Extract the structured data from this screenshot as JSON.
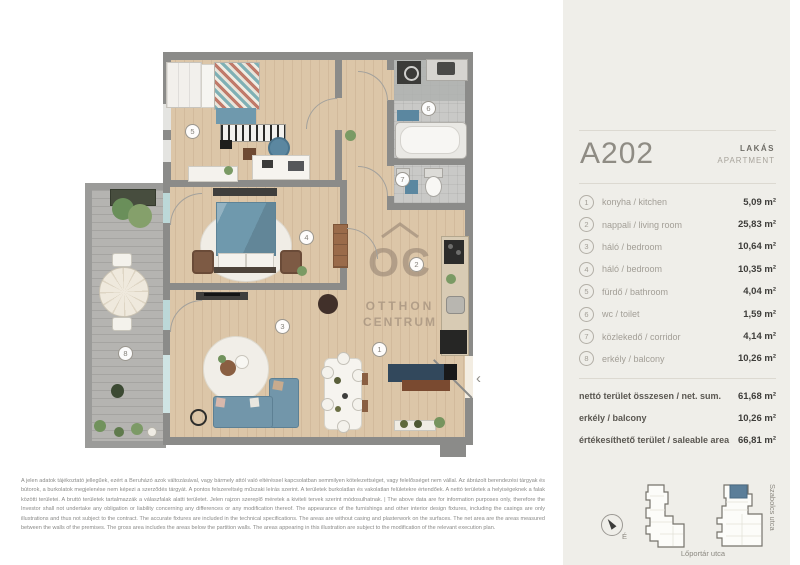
{
  "panel": {
    "unit_id": "A202",
    "type_hu": "LAKÁS",
    "type_en": "APARTMENT",
    "rooms": [
      {
        "num": "1",
        "label": "konyha  /  kitchen",
        "area": "5,09 m²"
      },
      {
        "num": "2",
        "label": "nappali  /  living room",
        "area": "25,83 m²"
      },
      {
        "num": "3",
        "label": "háló  /  bedroom",
        "area": "10,64 m²"
      },
      {
        "num": "4",
        "label": "háló  /  bedroom",
        "area": "10,35 m²"
      },
      {
        "num": "5",
        "label": "fürdő  /  bathroom",
        "area": "4,04 m²"
      },
      {
        "num": "6",
        "label": "wc  /  toilet",
        "area": "1,59 m²"
      },
      {
        "num": "7",
        "label": "közlekedő  /  corridor",
        "area": "4,14 m²"
      },
      {
        "num": "8",
        "label": "erkély  /  balcony",
        "area": "10,26 m²"
      }
    ],
    "totals": [
      {
        "label": "nettó terület összesen /  net. sum.",
        "value": "61,68 m²"
      },
      {
        "label": "erkély  /  balcony",
        "value": "10,26 m²"
      },
      {
        "label": "értékesíthető terület  /  saleable area",
        "value": "66,81 m²"
      }
    ],
    "siteplan": {
      "compass": "É",
      "street_bottom": "Lőportár utca",
      "street_right": "Szabolcs utca",
      "highlight_color": "#5b7e99"
    }
  },
  "plan": {
    "watermark": {
      "logo": "OC",
      "line1": "OTTHON",
      "line2": "CENTRUM"
    },
    "markers": [
      "1",
      "2",
      "3",
      "4",
      "5",
      "6",
      "7",
      "8"
    ],
    "entry_chevron": "‹",
    "colors": {
      "wall": "#8b8b89",
      "wood_floor": "#dcc6a8",
      "balcony_deck": "#b5b4b1",
      "accent_blue": "#6f99ad",
      "panel_bg": "#efeee9"
    }
  },
  "disclaimer": {
    "text": "A jelen adatok tájékoztató jellegűek, ezért a Beruházó azok változásával, vagy bármely attól való eltéréssel kapcsolatban semmilyen kötelezettséget, vagy felelősséget nem vállal. Az ábrázolt berendezési tárgyak és bútorok, a burkolatok megjelenése nem képezi a szerződés tárgyát. A pontos felszereltség műszaki leírás szerint. A területek burkolatlan és vakolatlan felületekre értendőek. A nettó területek a helyiségeknek a falak közötti területei. A bruttó területek tartalmazzák a válaszfalak alatti területet. Jelen rajzon szereplő méretek a kiviteli tervek szerint módosulhatnak. | The above data are for information purposes only, therefore the Investor shall not undertake any obligation or liability concerning any differences or any modification thereof. The appearance of the furnishings and other interior design fixtures, including the casings are only illustrations and thus not subject to the contract. The accurate fixtures are included in the technical specifications. The areas are without casing and plasterwork on the surfaces. The net area are the areas measured between the walls of the premises. The gross area includes the areas below the partition walls. The areas appearing in this illustration are subject to the modification of the relevant execution plan."
  }
}
